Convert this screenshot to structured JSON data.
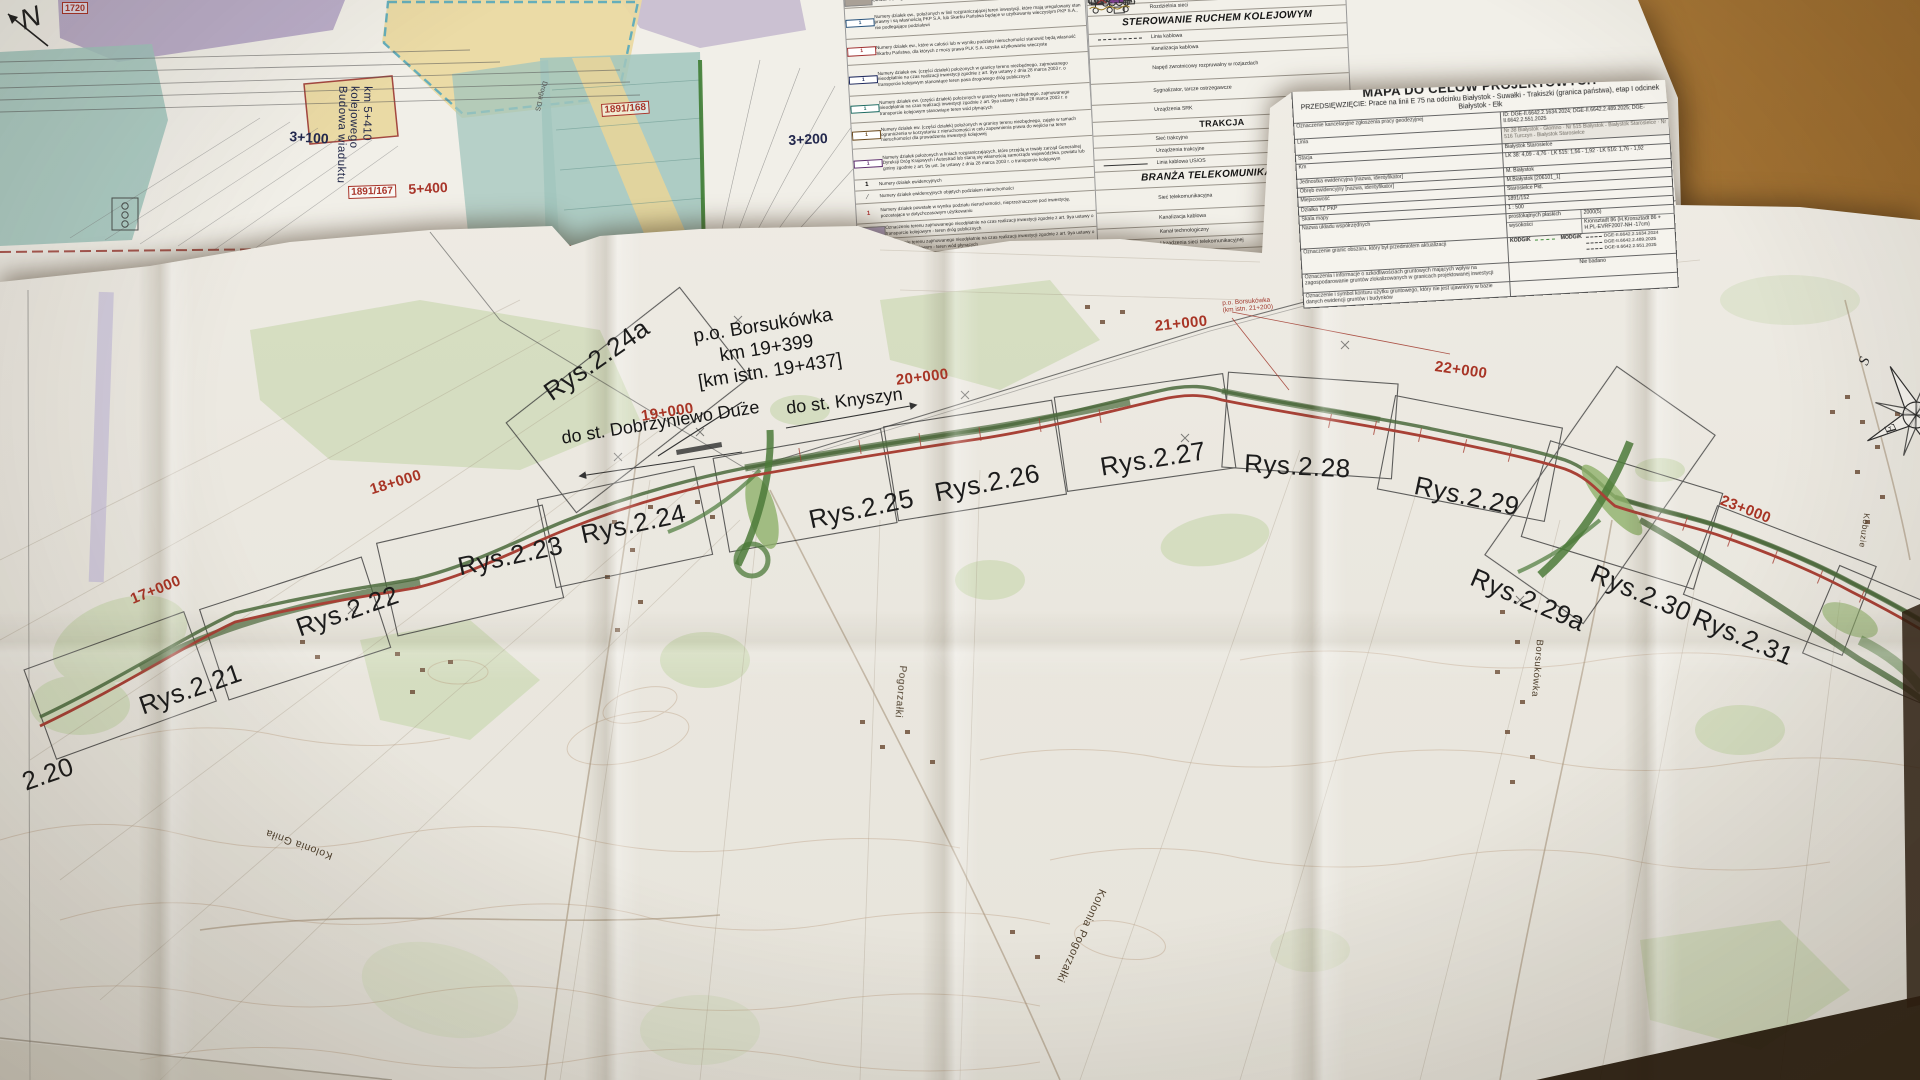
{
  "upper": {
    "north": "N",
    "box1720": "1720",
    "km3100": "3+100",
    "viaduct_line1": "Budowa wiaduktu kolejowego",
    "viaduct_line2": "km 5+410",
    "box1891_167": "1891/167",
    "km5400": "5+400",
    "box1891_168": "1891/168",
    "km3200": "3+200",
    "parcel144": "144",
    "rozb": "Rozb.",
    "droga": "Droga DS"
  },
  "legend_left": {
    "rows": [
      {
        "sym": "chip-gray",
        "text": "Obszar według odrębnego wniosku ULLK"
      },
      {
        "sym": "num-blue",
        "num": "1",
        "text": "Numery działek ew., położonych w linii rozgraniczającej teren inwestycji, które mają uregulowany stan prawny i są własnością PKP S.A. lub Skarbu Państwa będące w użytkowaniu wieczystym PKP S.A., nie podlegające podziałowi"
      },
      {
        "sym": "num-red",
        "num": "1",
        "text": "Numery działek ew., które w całości lub w wyniku podziału nieruchomości stanowić będą własność Skarbu Państwa, dla których z mocy prawa PLK S.A. uzyska użytkowanie wieczyste"
      },
      {
        "sym": "num-navy",
        "num": "1",
        "text": "Numery działek ew. (części działek) położonych w granicy terenu niezbędnego, zajmowanego nieodpłatnie na czas realizacji inwestycji zgodnie z art. 9ya ustawy z dnia 28 marca 2003 r. o transporcie kolejowym stanowiące teren pasa drogowego dróg publicznych"
      },
      {
        "sym": "num-teal",
        "num": "1",
        "text": "Numery działek ew. (części działek) położonych w granicy terenu niezbędnego, zajmowanego nieodpłatnie na czas realizacji inwestycji zgodnie z art. 9ya ustawy z dnia 28 marca 2003 r. o transporcie kolejowym stanowiące teren wód płynących"
      },
      {
        "sym": "num-brown",
        "num": "1",
        "text": "Numery działek ew. (części działek) położonych w granicy terenu niezbędnego, zajęte w ramach ograniczenia w korzystaniu z nieruchomości w celu zapewnienia prawa do wejścia na teren nieruchomości dla prowadzenia inwestycji kolejowej"
      },
      {
        "sym": "num-purple",
        "num": "1",
        "text": "Numery działek położonych w liniach rozgraniczających, które przejdą w trwały zarząd Generalnej Dyrekcji Dróg Krajowych i Autostrad lub staną się własnością samorządu województwa, powiatu lub gminy zgodnie z art. 9s ust. 3e ustawy z dnia 28 marca 2003 r. o transporcie kolejowym"
      },
      {
        "sym": "num-plain",
        "num": "1",
        "text": "Numery działek ewidencyjnych"
      },
      {
        "sym": "num-strike",
        "num": "1",
        "text": "Numery działek ewidencyjnych objętych podziałem nieruchomości"
      },
      {
        "sym": "num-red2",
        "num": "1",
        "text": "Numery działek powstałe w wyniku podziału nieruchomości, nieprzeznaczone pod inwestycję, pozostające w dotychczasowym użytkowaniu"
      },
      {
        "sym": "chip-purple",
        "text": "Oznaczenie terenu zajmowanego nieodpłatnie na czas realizacji inwestycji zgodnie z art. 9ya ustawy o transporcie kolejowym - teren dróg publicznych"
      },
      {
        "sym": "chip-blue",
        "text": "Oznaczenie terenu zajmowanego nieodpłatnie na czas realizacji inwestycji zgodnie z art. 9ya ustawy o transporcie kolejowym - teren wód płynących"
      },
      {
        "sym": "chip-yellow",
        "text": "Oznaczenie terenu, który przejdzie w trwały zarząd Generalnej Dyrekcji Dróg Krajowych i Autostrad"
      }
    ]
  },
  "legend_right": {
    "row_power": "Linia napowietrzna wysokiego napięcia",
    "row_rozdzielnia": "Rozdzielnia sieci",
    "srk_header": "STEROWANIE RUCHEM KOLEJOWYM",
    "srk_rows": [
      "Linia kablowa",
      "Kanalizacja kablowa",
      "Napęd zwrotnicowy rozpruwalny w rozjazdach",
      "Sygnalizator, tarcze ostrzegawcze",
      "Urządzenia SRK"
    ],
    "trakcja_header": "TRAKCJA",
    "trakcja_rows": [
      "Sieć trakcyjna",
      "Urządzenia trakcyjne",
      "Linia kablowa US/OS"
    ],
    "tele_header": "BRANŻA TELEKOMUNIKACYJNA",
    "tele_rows": [
      "Sieć telekomunikacyjna",
      "Kanalizacja kablowa",
      "Kanał technologiczny",
      "Urządzenia sieci telekomunikacyjnej"
    ]
  },
  "title_block": {
    "title": "MAPA DO CELÓW PROJEKTOWYCH",
    "subtitle": "PRZEDSIĘWZIĘCIE: Prace na linii E 75 na odcinku Białystok - Suwałki - Trakiszki (granica państwa), etap I odcinek Białystok - Ełk",
    "r1_label": "Oznaczenie kancelaryjne zgłoszenia pracy geodezyjnej",
    "r1_value": "ID: DGE-II.6642.2.1634.2024; DGE-II.6642.2.489.2025; DGE-II.6642.2.551.2025",
    "r2_label": "Linia",
    "r2_value": "Nr 38 Białystok - Głomno · Nr 515 Białystok - Białystok Starosielce · Nr 516 Turczyn - Białystok Starosielce",
    "r3_label": "Stacja",
    "r3_value": "Białystok Starosielce",
    "r4_label": "Km",
    "r4_value": "LK 38: 4,09 - 4,76 · LK 515: 1,56 - 1,92 · LK 516: 1,76 - 1,92",
    "r5_label": "Jednostka ewidencyjna [nazwa, identyfikator]",
    "r5_value": "M. Białystok",
    "r6_label": "Obręb ewidencyjny [nazwa, identyfikator]",
    "r6_value": "M.Białystok [206101_1]",
    "r7_label": "Miejscowość",
    "r7_value": "Starosielce Płd.",
    "r8_label": "Działka TZ PKP",
    "r8_value": "1891/152",
    "r9_label": "Skala mapy",
    "r9_value": "1 : 500",
    "r10_label": "Nazwa układu współrzędnych",
    "r10a_label": "prostokątnych płaskich",
    "r10a_value": "2000(5)",
    "r10b_label": "wysokości",
    "r10b_value": "Kronsztadt 86 (H.Kronsztadt 86 + H.PL-EVRF2007-NH -17cm)",
    "r11_label": "Oznaczenie granic obszaru, który był przedmiotem aktualizacji",
    "r11_kodgik": "KODGiK",
    "r11_modgik": "MODGiK",
    "r11_v1": "DGE-II.6642.2.1634.2024",
    "r11_v2": "DGE-II.6642.2.489.2025",
    "r11_v3": "DGE-II.6642.2.551.2025",
    "r12_label": "Oznaczenia i informacje o szkodliwościach gruntowych mających wpływ na zagospodarowanie gruntów zlokalizowanych w granicach projektowanej inwestycji",
    "r12_value": "Nie badano",
    "r13_label": "Oznaczenie i symbol konturu użytku gruntowego, który nie jest ujawniony w bazie danych ewidencji gruntów i budynków",
    "r13_value": ""
  },
  "map": {
    "km_labels": [
      "17+000",
      "18+000",
      "19+000",
      "20+000",
      "21+000",
      "22+000",
      "23+000"
    ],
    "sheet_labels": [
      "2.20",
      "Rys.2.21",
      "Rys.2.22",
      "Rys.2.23",
      "Rys.2.24",
      "Rys.2.24a",
      "Rys.2.25",
      "Rys.2.26",
      "Rys.2.27",
      "Rys.2.28",
      "Rys.2.29",
      "Rys.2.29a",
      "Rys.2.30",
      "Rys.2.31"
    ],
    "station": {
      "name": "p.o. Borsukówka",
      "km": "km 19+399",
      "km_istn": "[km istn. 19+437]"
    },
    "dir_left": "do st. Dobrzyniewo Duże",
    "dir_right": "do st. Knyszyn",
    "note_line1": "p.o. Borsukówka",
    "note_line2": "(km istn. 21+200)",
    "places": [
      "Kolonia Gniła",
      "Pogorzałki",
      "Kolonia Pogorzałki",
      "Borsukówka",
      "Kobuzie"
    ],
    "compass": {
      "s": "S",
      "e": "E"
    }
  },
  "colors": {
    "alignment_red": "#a84136",
    "project_green": "#4b6a3c",
    "km_label_red": "#a83526",
    "paper": "#eeebe3",
    "wood": "#bd8a4a"
  }
}
